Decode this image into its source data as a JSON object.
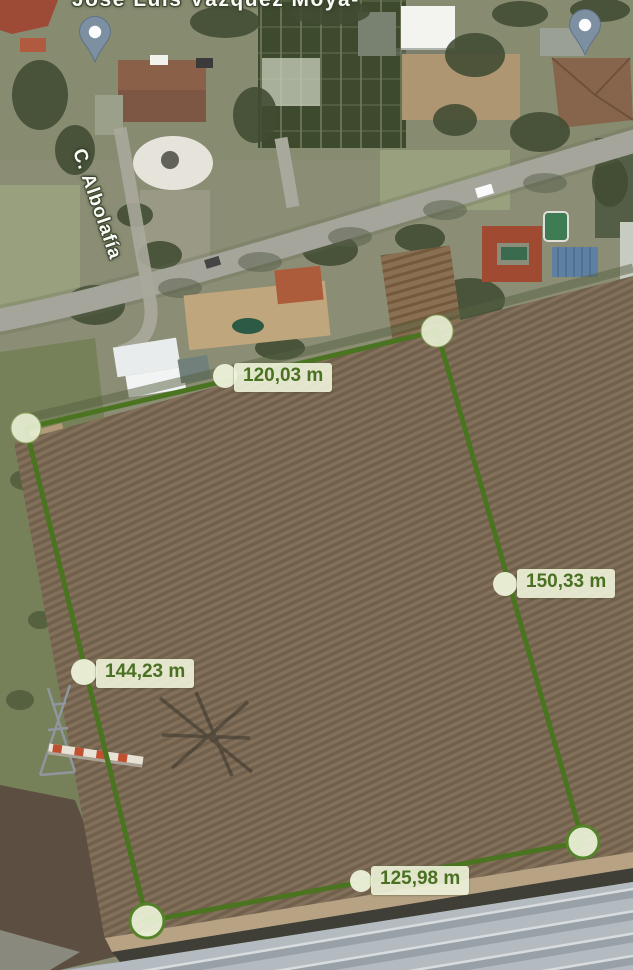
{
  "street_top": {
    "label": "José Luis Vázquez Moya-"
  },
  "street_left": {
    "label": "C. Albolafía"
  },
  "measurements": [
    {
      "side": "top",
      "value": "120,03 m"
    },
    {
      "side": "right",
      "value": "150,33 m"
    },
    {
      "side": "left",
      "value": "144,23 m"
    },
    {
      "side": "bottom",
      "value": "125,98 m"
    }
  ],
  "pins": [
    {
      "id": "pin-northwest"
    },
    {
      "id": "pin-northeast"
    }
  ],
  "colors": {
    "measure_line": "#4a7420",
    "vertex_fill": "#eaf1d5",
    "label_bg": "#eef3da",
    "label_text": "#4a7022",
    "pin": "#7d90a2",
    "field": "#7d6a52"
  }
}
